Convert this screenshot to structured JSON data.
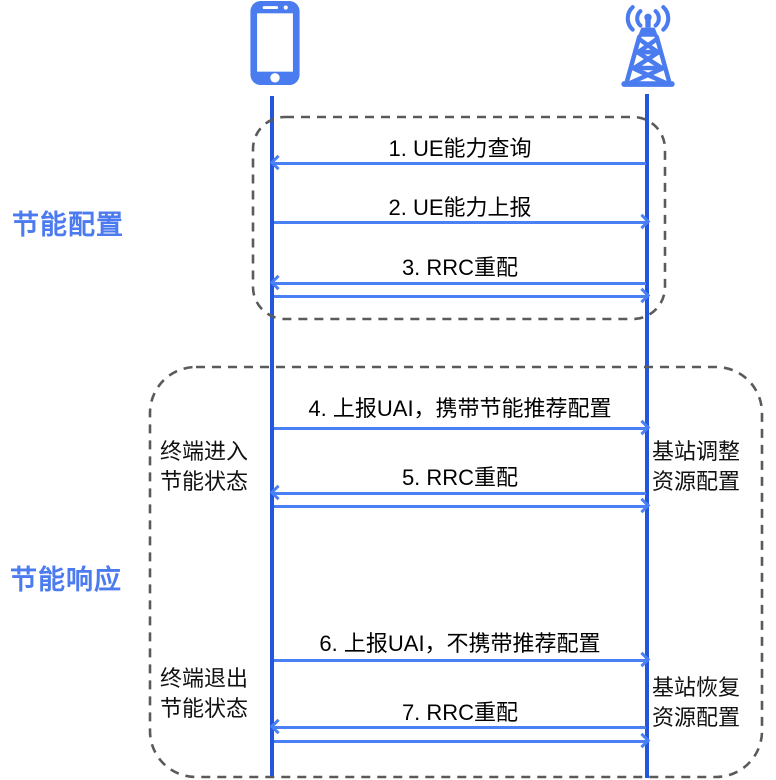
{
  "actors": {
    "ue_icon": "smartphone-icon",
    "bs_icon": "base-station-icon"
  },
  "groups": {
    "config": {
      "label": "节能配置"
    },
    "response": {
      "label": "节能响应"
    }
  },
  "messages": [
    {
      "label": "1. UE能力查询",
      "direction": "left"
    },
    {
      "label": "2. UE能力上报",
      "direction": "right"
    },
    {
      "label": "3. RRC重配",
      "direction": "both"
    },
    {
      "label": "4. 上报UAI，携带节能推荐配置",
      "direction": "right"
    },
    {
      "label": "5. RRC重配",
      "direction": "both"
    },
    {
      "label": "6. 上报UAI，不携带推荐配置",
      "direction": "right"
    },
    {
      "label": "7. RRC重配",
      "direction": "both"
    }
  ],
  "notes": [
    {
      "label": "终端进入\n节能状态",
      "side": "left"
    },
    {
      "label": "基站调整\n资源配置",
      "side": "right"
    },
    {
      "label": "终端退出\n节能状态",
      "side": "left"
    },
    {
      "label": "基站恢复\n资源配置",
      "side": "right"
    }
  ],
  "colors": {
    "icon_blue": "#4a7cf0",
    "lifeline_blue": "#2356dd",
    "arrow_blue": "#4a80f5",
    "group_label_blue": "#4c7bf0",
    "dashed_border": "#5a5a5a",
    "text": "#000000"
  }
}
